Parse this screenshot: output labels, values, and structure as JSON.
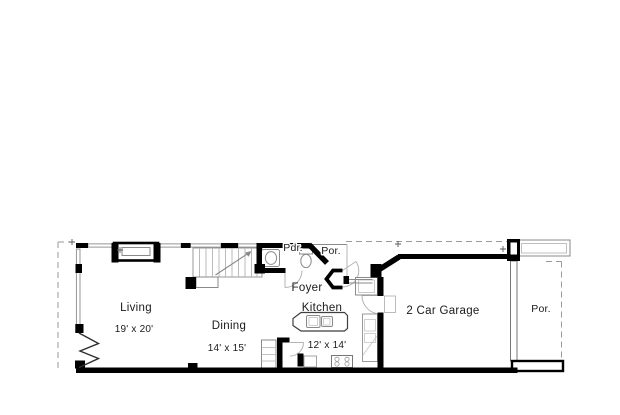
{
  "rooms": {
    "living": {
      "name": "Living",
      "dims": "19' x 20'"
    },
    "dining": {
      "name": "Dining",
      "dims": "14' x 15'"
    },
    "kitchen": {
      "name": "Kitchen",
      "dims": "12' x 14'"
    },
    "foyer": {
      "name": "Foyer"
    },
    "powder_room": {
      "name": "Pdr."
    },
    "entry_porch": {
      "name": "Por."
    },
    "garage": {
      "name": "2 Car Garage"
    },
    "side_porch": {
      "name": "Por."
    }
  },
  "colors": {
    "walls": "#000000",
    "thin_lines": "#8a8a8a",
    "light_lines": "#b4b4b4",
    "dashed_property_line": "#9a9a9a",
    "text": "#1a1a1a",
    "background": "#ffffff"
  }
}
